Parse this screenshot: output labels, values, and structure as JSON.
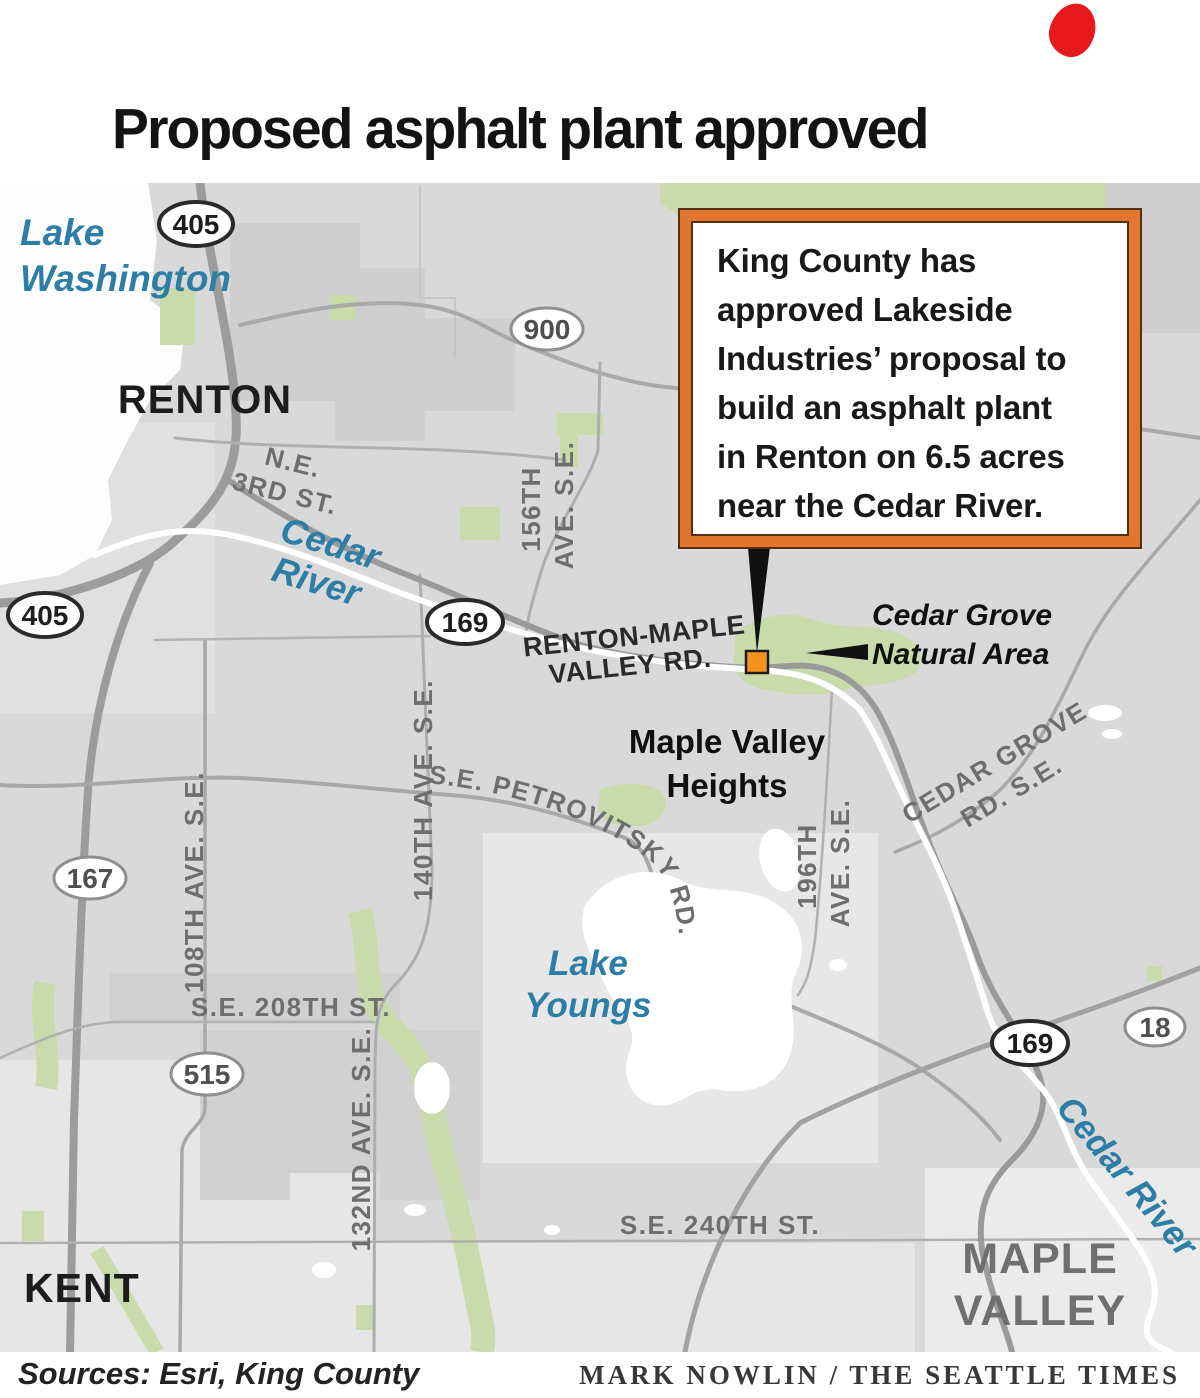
{
  "title": "Proposed asphalt plant approved",
  "callout": {
    "lines": [
      "King County has",
      "approved Lakeside",
      "Industries’ proposal to",
      "build an asphalt plant",
      "in Renton on 6.5 acres",
      "near the Cedar River."
    ]
  },
  "map": {
    "cities": {
      "renton": "RENTON",
      "kent": "KENT",
      "maple_valley_1": "MAPLE",
      "maple_valley_2": "VALLEY"
    },
    "places": {
      "maple_valley_heights_1": "Maple Valley",
      "maple_valley_heights_2": "Heights",
      "cedar_grove_area_1": "Cedar Grove",
      "cedar_grove_area_2": "Natural Area"
    },
    "water": {
      "lake_washington_1": "Lake",
      "lake_washington_2": "Washington",
      "cedar_river_upper_1": "Cedar",
      "cedar_river_upper_2": "River",
      "lake_youngs_1": "Lake",
      "lake_youngs_2": "Youngs",
      "cedar_river_lower": "Cedar River"
    },
    "roads": {
      "ne_3rd_1": "N.E.",
      "ne_3rd_2": "3RD ST.",
      "renton_maple_1": "RENTON-MAPLE",
      "renton_maple_2": "VALLEY RD.",
      "petrovitsky": "S.E. PETROVITSKY RD.",
      "cedar_grove_rd_1": "CEDAR GROVE",
      "cedar_grove_rd_2": "RD. S.E.",
      "ave_156_1": "156TH",
      "ave_156_2": "AVE. S.E.",
      "ave_140": "140TH AVE. S.E.",
      "ave_196_1": "196TH",
      "ave_196_2": "AVE. S.E.",
      "ave_108": "108TH AVE. S.E.",
      "ave_132": "132ND AVE. S.E.",
      "st_208": "S.E. 208TH ST.",
      "st_240": "S.E. 240TH ST."
    },
    "shields": {
      "i405a": "405",
      "i405b": "405",
      "sr900": "900",
      "sr169a": "169",
      "sr169b": "169",
      "sr167": "167",
      "sr515": "515",
      "sr18": "18"
    }
  },
  "footer": {
    "sources": "Sources: Esri, King County",
    "credit": "MARK NOWLIN / THE SEATTLE TIMES"
  },
  "colors": {
    "callout_border_orange": "#e2762e",
    "site_marker_orange": "#f5921e",
    "red_blob": "#e8191c",
    "water_label_blue": "#2d7ea6",
    "land_gray": "#d9d9d9",
    "park_green": "#c7dcaa"
  }
}
